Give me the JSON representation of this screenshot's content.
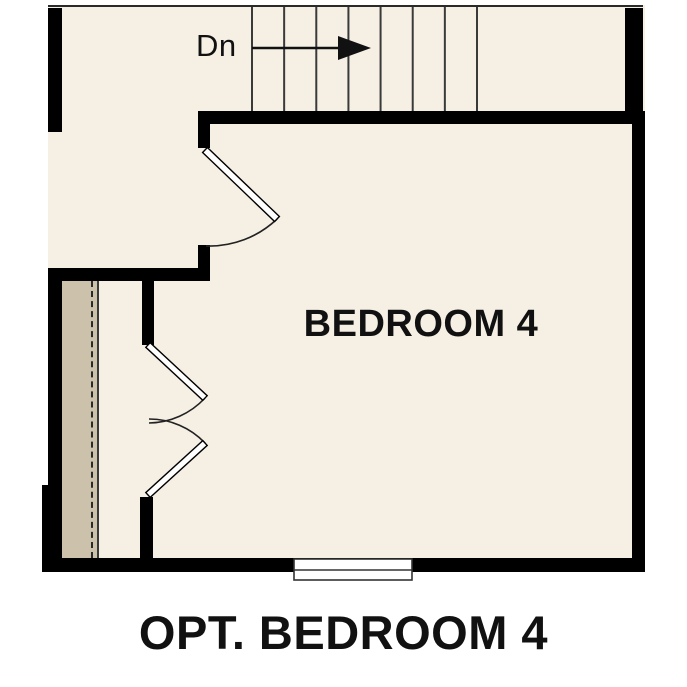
{
  "plan": {
    "caption": "OPT. BEDROOM 4",
    "room": {
      "label": "BEDROOM 4"
    },
    "stairs": {
      "direction_label": "Dn",
      "tread_count": 8,
      "arrow_icon": "right-arrow-icon"
    },
    "colors": {
      "floor": "#f6efe4",
      "closet_floor": "#ccc2ac",
      "wall": "#000000",
      "stair_line": "#3a3a3a",
      "text": "#111111",
      "background": "#ffffff"
    }
  }
}
